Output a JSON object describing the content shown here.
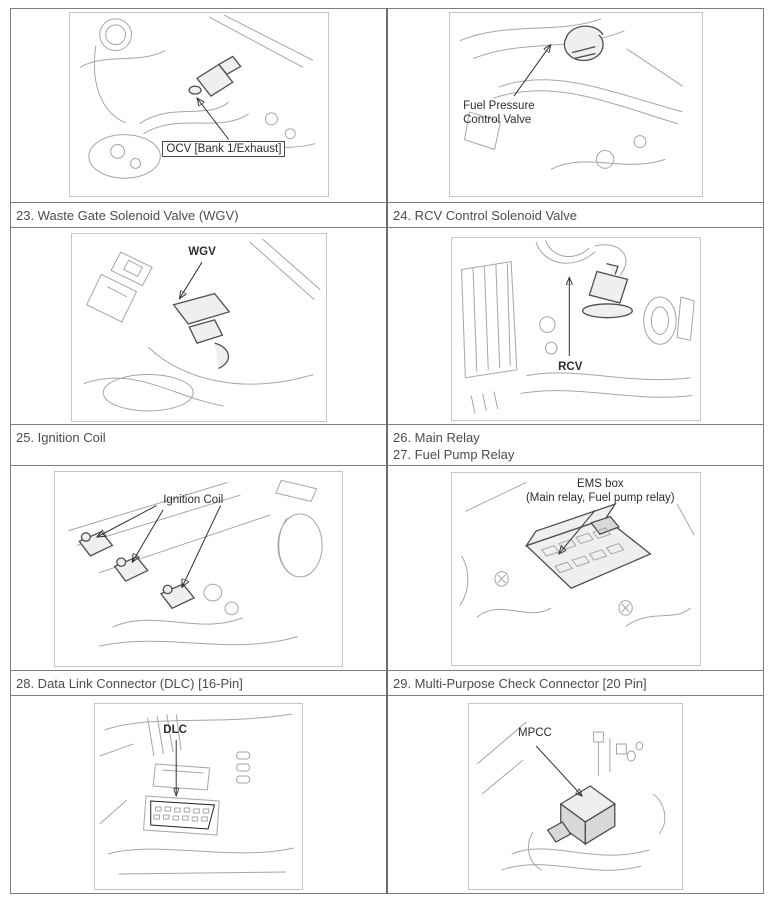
{
  "colors": {
    "page_bg": "#ffffff",
    "table_border": "#7d7d7d",
    "figure_box_border": "#c6c6c6",
    "caption_text": "#4d4d4d",
    "callout_text": "#2e2e2e",
    "line_art": "#a6a6a6",
    "line_art_dark": "#4f4f4f"
  },
  "captions": {
    "row1": {
      "left": "23. Waste Gate Solenoid Valve (WGV)",
      "right": "24. RCV Control Solenoid Valve"
    },
    "row2": {
      "left": "25. Ignition Coil",
      "right_line1": "26. Main Relay",
      "right_line2": "27. Fuel Pump Relay"
    },
    "row3": {
      "left": "28. Data Link Connector (DLC) [16-Pin]",
      "right": "29. Multi-Purpose Check Connector [20 Pin]"
    }
  },
  "figures": {
    "ocv": {
      "callout": "OCV [Bank 1/Exhaust]"
    },
    "fuel_pressure_control_valve": {
      "callout": "Fuel Pressure Control Valve"
    },
    "wgv": {
      "callout": "WGV"
    },
    "rcv": {
      "callout": "RCV"
    },
    "ignition_coil": {
      "callout": "Ignition Coil"
    },
    "ems_box": {
      "callout_line1": "EMS box",
      "callout_line2": "(Main relay, Fuel pump relay)"
    },
    "dlc": {
      "callout": "DLC"
    },
    "mpcc": {
      "callout": "MPCC"
    }
  }
}
